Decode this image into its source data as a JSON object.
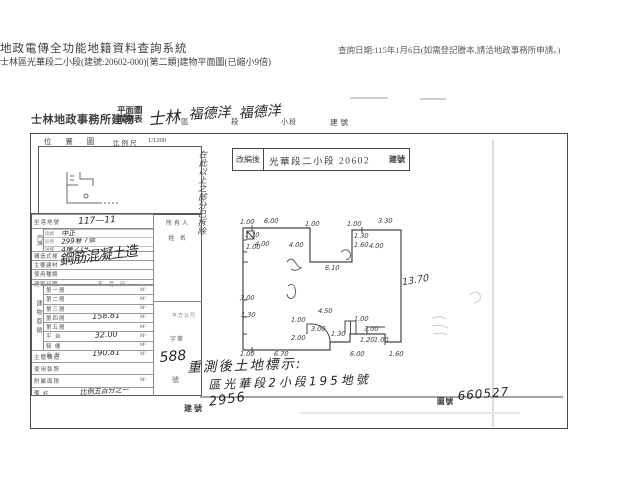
{
  "header": {
    "system_title": "地政電傳全功能地籍資料查詢系統",
    "query_note": "查詢日期:115年1月6日(如需登記謄本,請洽地政事務所申請。)",
    "doc_line": "士林區光華段二小段(建號:20602-000)[第二類]建物平面圖(已縮小9倍)"
  },
  "title": {
    "office": "士林地政事務所建物",
    "stack_top": "平面圖",
    "stack_bottom": "成果表",
    "hand_district": "士林",
    "lbl_district": "區",
    "hand_section": "福德洋",
    "lbl_section": "段",
    "hand_subsection": "福德洋",
    "lbl_subsection": "小段",
    "lbl_building_no": "建號"
  },
  "location_map": {
    "label": "位 置 圖",
    "scale_label": "比例尺",
    "scale_value": "1/1200"
  },
  "stamp": {
    "label": "改編後",
    "value": "光華段二小段 20602",
    "suffix": "建號"
  },
  "side_note": "在此以上之部分已拆除",
  "table": {
    "site_label": "坐落地號",
    "site_value": "117—11",
    "owner_top": "所有人",
    "owner_bottom": "姓 名",
    "door_label": "門牌",
    "door_rows": [
      {
        "lbl": "街路",
        "hand": "中正"
      },
      {
        "lbl": "段巷",
        "hand": "299巷 7號"
      },
      {
        "lbl": "號樓",
        "hand": "4樓之14"
      }
    ],
    "attr_rows": [
      {
        "label": "構造式樣",
        "value": ""
      },
      {
        "label": "主要建材",
        "value": ""
      },
      {
        "label": "使用種類",
        "value": ""
      },
      {
        "label": "建築日期",
        "value": "年　月　日"
      }
    ],
    "attr_hand": "鋼筋混凝土造",
    "area_vertical": "建物面積",
    "area_rows": [
      {
        "label": "第一層",
        "value": "",
        "unit": "M²"
      },
      {
        "label": "第二層",
        "value": "",
        "unit": "M²"
      },
      {
        "label": "第三層",
        "value": "",
        "unit": "M²"
      },
      {
        "label": "第四層",
        "value": "158.81",
        "unit": "M²"
      },
      {
        "label": "第五層",
        "value": "",
        "unit": "M²"
      },
      {
        "label": "平 台",
        "value": "32.00",
        "unit": "M²"
      },
      {
        "label": "騎 樓",
        "value": "",
        "unit": "M²"
      },
      {
        "label": "合 計",
        "value": "190.81",
        "unit": "M²"
      }
    ],
    "unit_note": "平方公尺",
    "lower_rows": [
      {
        "label": "主體構造",
        "value": "",
        "unit": ""
      },
      {
        "label": "使用執照",
        "value": "",
        "unit": ""
      },
      {
        "label": "附屬面積",
        "value": "",
        "unit": "M²"
      },
      {
        "label": "備 註",
        "value": "比例五百分之一",
        "unit": ""
      }
    ],
    "permit": {
      "prefix": "字第",
      "number": "588",
      "suffix": "號"
    }
  },
  "plan": {
    "dims": [
      {
        "t": "1.00",
        "x": 240,
        "y": 218
      },
      {
        "t": "6.00",
        "x": 264,
        "y": 217
      },
      {
        "t": "1.00",
        "x": 305,
        "y": 220
      },
      {
        "t": "1.00",
        "x": 347,
        "y": 220
      },
      {
        "t": "3.30",
        "x": 378,
        "y": 217
      },
      {
        "t": "1.30",
        "x": 245,
        "y": 231
      },
      {
        "t": "1.00",
        "x": 246,
        "y": 243
      },
      {
        "t": "4.00",
        "x": 255,
        "y": 240
      },
      {
        "t": "4.00",
        "x": 289,
        "y": 241
      },
      {
        "t": "1.30",
        "x": 354,
        "y": 232
      },
      {
        "t": "1.60",
        "x": 354,
        "y": 241
      },
      {
        "t": "4.00",
        "x": 369,
        "y": 242
      },
      {
        "t": "6.10",
        "x": 325,
        "y": 264
      },
      {
        "t": "13.70",
        "x": 402,
        "y": 275,
        "r": -10,
        "cls": "big"
      },
      {
        "t": "3.00",
        "x": 240,
        "y": 294
      },
      {
        "t": "1.30",
        "x": 241,
        "y": 311
      },
      {
        "t": "4.50",
        "x": 318,
        "y": 307
      },
      {
        "t": "1.00",
        "x": 291,
        "y": 316
      },
      {
        "t": "3.00",
        "x": 311,
        "y": 325
      },
      {
        "t": "2.00",
        "x": 291,
        "y": 334
      },
      {
        "t": "1.30",
        "x": 331,
        "y": 330
      },
      {
        "t": "1.00",
        "x": 354,
        "y": 315
      },
      {
        "t": "3.00",
        "x": 364,
        "y": 325
      },
      {
        "t": "1.20",
        "x": 360,
        "y": 336
      },
      {
        "t": "1.00",
        "x": 374,
        "y": 336
      },
      {
        "t": "1.00",
        "x": 240,
        "y": 350
      },
      {
        "t": "6.70",
        "x": 274,
        "y": 350
      },
      {
        "t": "6.00",
        "x": 350,
        "y": 350
      },
      {
        "t": "1.60",
        "x": 389,
        "y": 350
      }
    ]
  },
  "bottom_note": {
    "title": "重測後土地標示:",
    "line": "區光華段2小段195地號",
    "building_label": "建號",
    "building_value": "2956",
    "map_label": "圖號",
    "map_value": "660527"
  }
}
